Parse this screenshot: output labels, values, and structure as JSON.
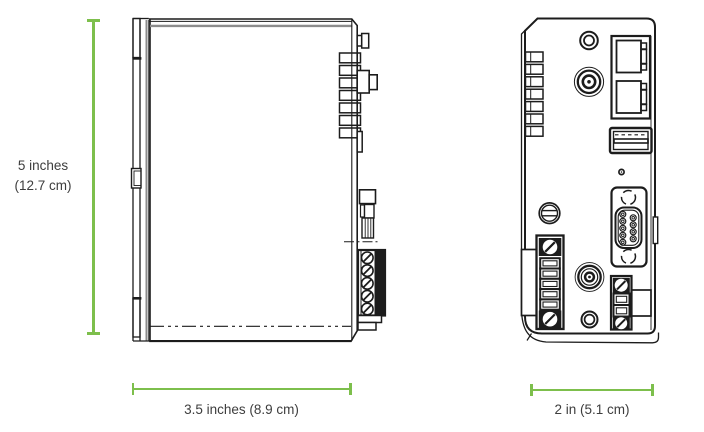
{
  "colors": {
    "accent": "#7dbf4c",
    "text": "#3d3d3d",
    "ink": "#1c1c1c",
    "ink_gray": "#8c8c8c",
    "background": "#ffffff"
  },
  "dimensions": {
    "height_label_line1": "5 inches",
    "height_label_line2": "(12.7 cm)",
    "width_label": "3.5 inches (8.9 cm)",
    "depth_label": "2 in (5.1 cm)"
  }
}
